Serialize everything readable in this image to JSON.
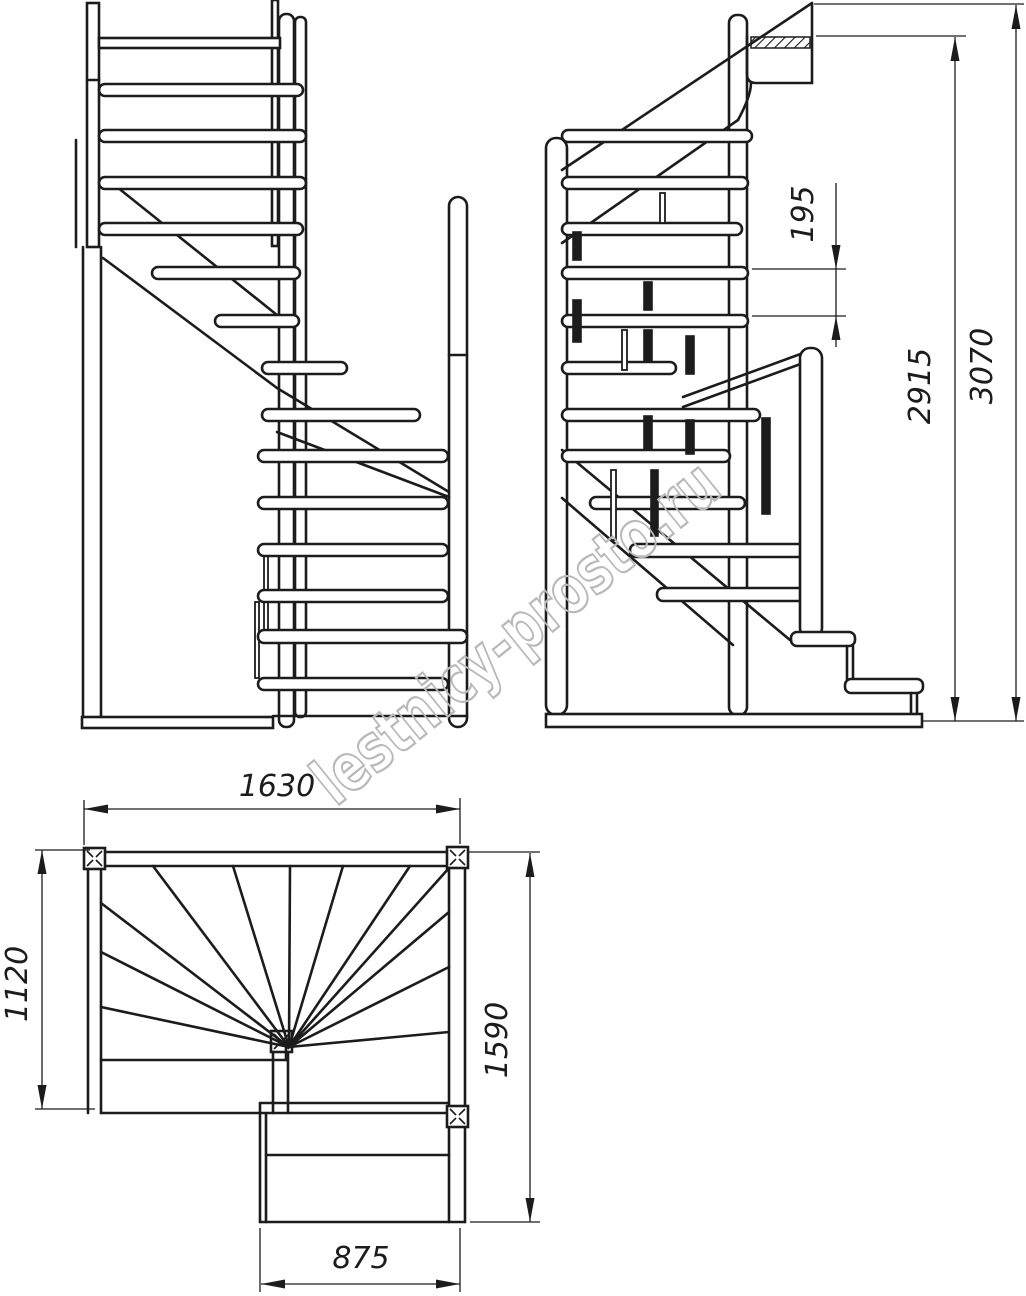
{
  "title": "Winder staircase technical drawing",
  "watermark": "lestnicy-prosto.ru",
  "views": {
    "front_elevation": {
      "name": "front elevation"
    },
    "side_elevation": {
      "riser_spacing": "195",
      "handrail_level_height": "2915",
      "total_height": "3070"
    },
    "plan": {
      "overall_width": "1630",
      "left_depth": "1120",
      "right_depth": "1590",
      "lower_flight_width": "875"
    }
  },
  "colors": {
    "line": "#1c1c1c",
    "watermark": "#b9b9b9",
    "background": "#ffffff"
  }
}
